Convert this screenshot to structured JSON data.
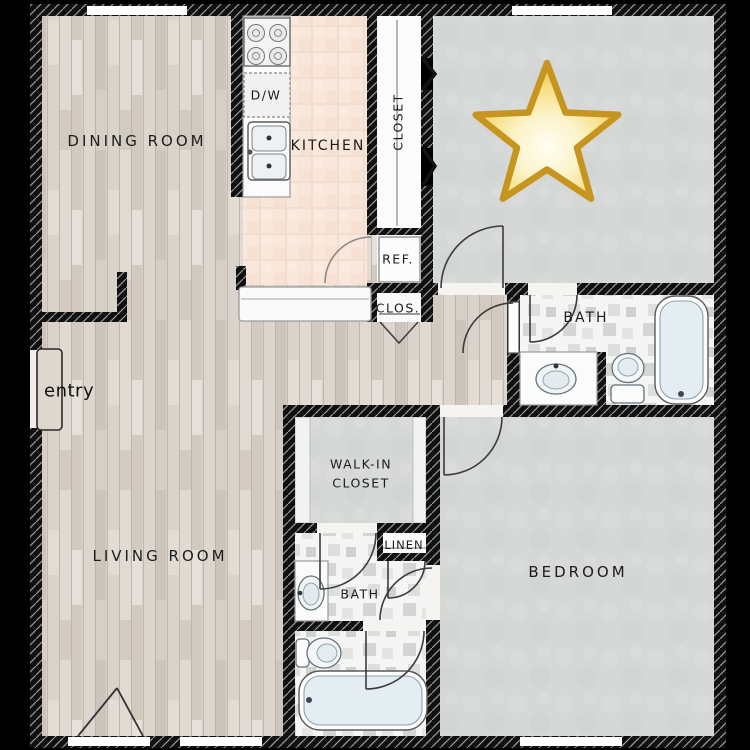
{
  "document": {
    "type": "apartment-floor-plan"
  },
  "labels": {
    "dining": "DINING ROOM",
    "kitchen": "KITCHEN",
    "dw": "D/W",
    "closet": "CLOSET",
    "ref": "REF.",
    "clos": "CLOS.",
    "bath_upper": "BATH",
    "walk_in_1": "WALK-IN",
    "walk_in_2": "CLOSET",
    "linen": "LINEN",
    "bath_lower": "BATH",
    "bedroom": "BEDROOM",
    "living": "LIVING ROOM",
    "entry": "entry"
  },
  "marker": {
    "icon": "star-emoji",
    "fill": "#f6d96b",
    "outline": "#c6951f"
  },
  "palette": {
    "background": "#000000",
    "wall": "#111111",
    "wall_hatch": "#9a9a9a",
    "wood_floor": "#d8d1c8",
    "kitchen_tile": "#f8e6da",
    "carpet": "#d5d8d6",
    "bath_tile": "#f3f4f3",
    "label_ink": "#1c1c1c"
  }
}
